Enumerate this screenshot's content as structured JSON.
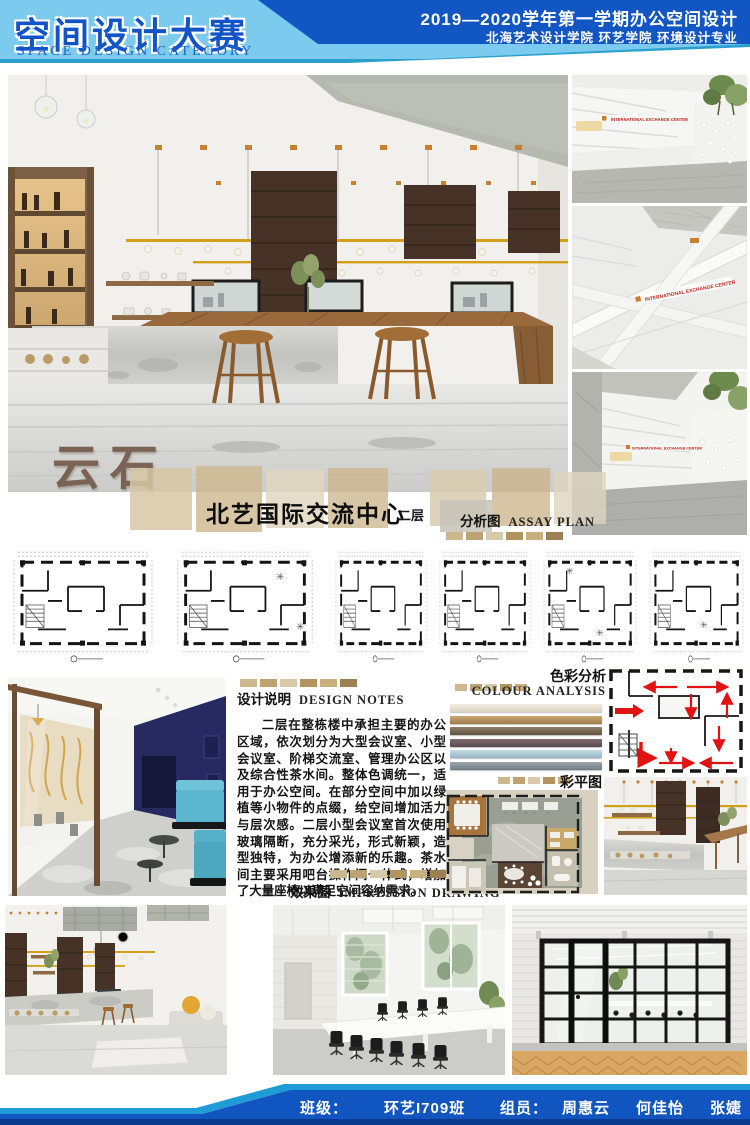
{
  "header": {
    "title_cn": "空间设计大赛",
    "title_en": "SPACE DESIGN CATEGORY",
    "course_line": "2019—2020学年第一学期办公空间设计",
    "school_line": "北海艺术设计学院 环艺学院 环境设计专业",
    "colors": {
      "light_blue": "#7ccaed",
      "dark_blue": "#1256c4",
      "title_blue": "#1353c8",
      "divider_blue": "#2ba0cf"
    }
  },
  "hero": {
    "watermark": "云石",
    "caption_title": "北艺国际交流中心",
    "caption_sub": "二层",
    "model_sign_text": "INTERNATIONAL EXCHANGE CENTER",
    "sign_color": "#c2251d"
  },
  "labels": {
    "assay": {
      "cn": "分析图",
      "en": "ASSAY PLAN"
    },
    "notes": {
      "cn": "设计说明",
      "en": "DESIGN NOTES"
    },
    "colour": {
      "cn": "色彩分析",
      "en": "COLOUR ANALYSIS"
    },
    "colour_plan": {
      "cn": "彩平图"
    },
    "impression": {
      "cn": "效果图",
      "en": "IMPRESSION DRAWING"
    }
  },
  "notes_text": "二层在整栋楼中承担主要的办公区域，依次划分为大型会议室、小型会议室、阶梯交流室、管理办公区以及综合性茶水间。整体色调统一，适用于办公空间。在部分空间中加以绿植等小物件的点缀，给空间增加活力与层次感。二层小型会议室首次使用玻璃隔断，充分采光，形式新颖，造型独特，为办公增添新的乐趣。茶水间主要采用吧台操作间一体式，增加了大量座椅以满足空间容纳需求。",
  "colour_analysis": {
    "bars": [
      {
        "from": "#f1ede1",
        "to": "#d9d2be"
      },
      {
        "from": "#c9a873",
        "to": "#a07b4a"
      },
      {
        "from": "#90806a",
        "to": "#615440"
      },
      {
        "from": "#7f6c6c",
        "to": "#564a4e"
      },
      {
        "from": "#c5dae4",
        "to": "#97b8c9"
      },
      {
        "from": "#9da7ad",
        "to": "#6f7c84"
      }
    ]
  },
  "decor": {
    "swatch_colors": [
      "#cdb78f",
      "#bfa271",
      "#d8c9a8",
      "#b3945f",
      "#c9af80",
      "#9c7f52"
    ]
  },
  "footer": {
    "class_label": "班级：",
    "class_value": "环艺I709班",
    "team_label": "组员：",
    "members": [
      "周惠云",
      "何佳怡",
      "张婕"
    ],
    "colors": {
      "bar_blue": "#1155c0",
      "stripe_cyan": "#1f9cd6",
      "base_navy": "#0a3a8e"
    }
  }
}
